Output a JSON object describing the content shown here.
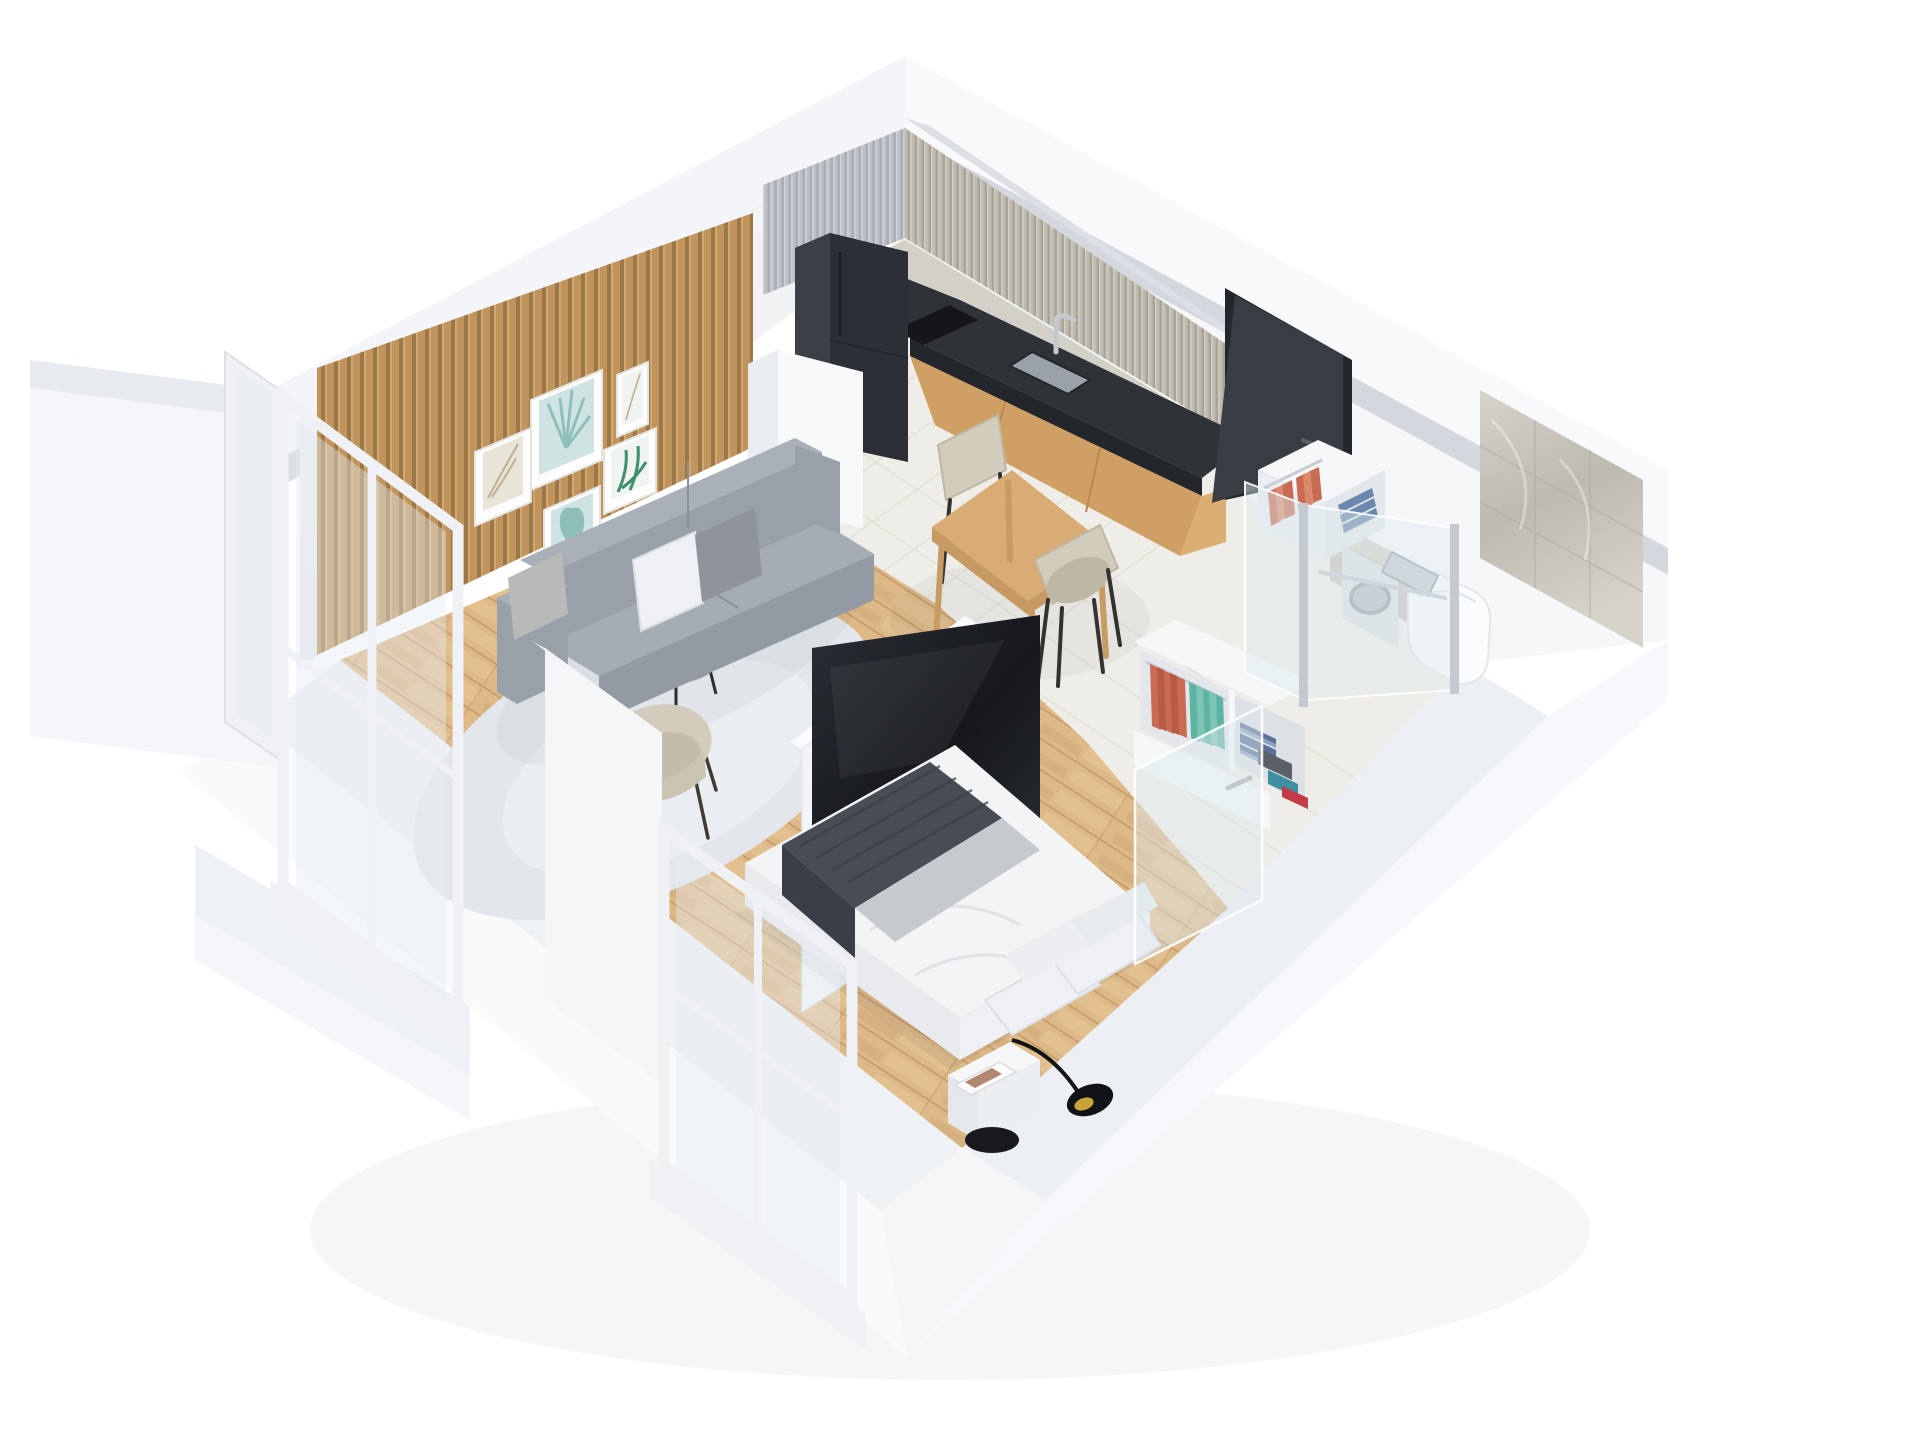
{
  "meta": {
    "title": "Isometric 3D cutaway render of a studio apartment floor plan",
    "view": "axonometric top-down cutaway",
    "canvas": {
      "width": 1920,
      "height": 1440
    }
  },
  "colors": {
    "bg": "#ffffff",
    "outerBandNW": "#f3f5f8",
    "outerBandNE": "#f7f9fb",
    "cutBand": "#dcdfe4",
    "cutBandDark": "#d4d7dd",
    "plinthTopSW": "#eff2f5",
    "plinthFaceSW": "#f9fafc",
    "plinthTopSE": "#ecEFf4",
    "plinthFaceSE": "#f6f8fb",
    "wallNW1": "#f4f5f7",
    "wallNW2": "#e9ecef",
    "wallNE": "#f6f7f9",
    "slatBase": "#c89a63",
    "slatDark": "#a07a4a",
    "slatLight": "#dab077",
    "frameWhite": "#fdfdfd",
    "frameEdge": "#e4e4e0",
    "artTealLight": "#cfe4e2",
    "artTeal": "#8fbfba",
    "artGreen": "#3e8f6a",
    "artBeige": "#e9e4d8",
    "artBeigeDark": "#bdb093",
    "artPale": "#eff3f1",
    "fluteCoolBase": "#bdc0c5",
    "fluteCoolDark": "#a9adb3",
    "fluteCoolLight": "#cdd0d5",
    "fluteWarmBase": "#c0bbb0",
    "fluteWarmDark": "#a9a498",
    "fluteWarmLight": "#d0ccc2",
    "splashMarble": "#d3d0c8",
    "counterTop": "#2f3338",
    "counterFace": "#23262b",
    "sinkGray": "#9aa1a8",
    "chrome": "#c3c9cf",
    "chromeDark": "#9aa1a8",
    "cooktop": "#141619",
    "woodCab": "#cf9f63",
    "woodCabDark": "#b9894f",
    "woodCabEnd": "#dcae72",
    "fridgeFront": "#2c3036",
    "fridgeSide": "#3a4046",
    "fridgeTop": "#24272b",
    "fridgeSeam": "#1d2023",
    "colWhiteF": "#f7f9fb",
    "colWhiteS": "#e9edf1",
    "colWhiteT": "#eef1f4",
    "doorDark": "#383c43",
    "doorFrame": "#23262b",
    "marble1": "#d6d3ca",
    "marble2": "#bdbab0",
    "marbleVein": "#a9a69b",
    "halfWall": "#c7c4bb",
    "toilet": "#fbfcfd",
    "toiletShade": "#e3e6ea",
    "washerFront": "#dde0e3",
    "washerRing": "#9aa0a7",
    "washerGlass": "#b9bec4",
    "glassFill": "rgba(222,232,238,0.45)",
    "glassStroke": "rgba(255,255,255,0.9)",
    "floorWood": "#deb988",
    "plankLine": "#c49a68",
    "plankLight": "#e7c797",
    "tile": "#efede8",
    "grout": "#dfdcd5",
    "rug": "#e3e7eb",
    "rugInner": "#ebeef1",
    "tableWood": "#d8ac74",
    "tableEdge": "#c69a62",
    "tableLeg": "#c79b63",
    "chairBeige": "#d2ccbd",
    "chairBeigeDark": "#bfb7a5",
    "chairLeg": "#35312c",
    "sofaBack": "#aab0b8",
    "sofaMid": "#9aa0a9",
    "sofaSeat": "#a6acb4",
    "sofaDark": "#8a9099",
    "sofaFront": "#939aa3",
    "pillowWhite": "#eef0f3",
    "pillowGray": "#8f939b",
    "pillowShade": "#dcdfe3",
    "tvDark1": "#2b3036",
    "tvDark2": "#15171b",
    "partWhite": "#f2f4f7",
    "partTop": "#fafbfd",
    "partEdge": "#e4e7eb",
    "bedSideSW": "#e8eaed",
    "bedSideSE": "#eef0f3",
    "duvet": "#f3f4f6",
    "duvetLine": "#dfe2e6",
    "throw1": "#474c55",
    "throw2": "#393e47",
    "nightTop": "#f6f7f9",
    "nightFront": "#eceff2",
    "nightSide": "#e4e7eb",
    "lampBlack": "#121316",
    "lampGold": "#c9a43c",
    "stoolBlack": "#17191c",
    "wardWhite": "#f5f7f9",
    "wardShade": "#eaedf1",
    "wardInner": "#e3e7ec",
    "wardInnerDark": "#dde1e6",
    "railChrome": "#c6ccd2",
    "clothCoral1": "#c96a52",
    "clothCoral2": "#d98a6a",
    "clothCoral3": "#b85a48",
    "clothTeal1": "#5fb3a1",
    "clothTeal2": "#7cc4b4",
    "jeans1": "#5a7099",
    "jeans2": "#6b87ae",
    "jeans3": "#4e6288",
    "foldGray": "#5a5f68",
    "foldTealBox": "#3f8fa3",
    "foldRed": "#c23b49",
    "foldBlueLight": "#8aa2c4",
    "winFrame": "#eff1f4",
    "winFrameShade": "#dde1e6",
    "winGlass": "rgba(228,236,240,0.42)",
    "pierFace": "#f5f6f8",
    "pierTop": "#e9ecf0",
    "balc1": "#f4f6f9",
    "balc2": "#eef1f5",
    "balc3": "#e7ebf0",
    "shadow": "rgba(30,41,59,0.07)",
    "shadowSoft": "rgba(30,41,59,0.045)"
  },
  "scene": {
    "background": "#ffffff",
    "style": "white cutaway walls, oak and light-tile floors, scandinavian furniture",
    "rooms": [
      {
        "id": "living-room",
        "label": "Living room",
        "floor": "oak plank",
        "features": [
          "wood-slat-accent-wall",
          "gallery-wall-five-botanical-prints",
          "gray-three-seat-sofa",
          "two-throw-pillows",
          "round-gray-rug",
          "two-round-nesting-coffee-tables",
          "beige-armchair"
        ]
      },
      {
        "id": "kitchen",
        "label": "Kitchen",
        "floor": "light tile",
        "features": [
          "dark-two-door-fridge",
          "white-tall-column",
          "gray-fluted-upper-cabinets-both-walls",
          "marble-backsplash-strip",
          "dark-stone-countertop-L-shape",
          "induction-cooktop",
          "undermount-sink",
          "chrome-faucet",
          "oak-base-cabinets"
        ]
      },
      {
        "id": "dining-area",
        "label": "Dining area",
        "floor": "light tile",
        "features": [
          "oak-dining-table",
          "beige-upholstered-chair-north",
          "beige-upholstered-chair-south"
        ]
      },
      {
        "id": "sleeping-area",
        "label": "Sleeping area",
        "floor": "oak plank",
        "features": [
          "double-bed-white-duvet",
          "stacked-white-pillows",
          "dark-gray-fringed-throw",
          "white-tv-partition-wall",
          "flat-screen-tv",
          "white-nightstand",
          "black-task-lamp",
          "black-round-side-table"
        ]
      },
      {
        "id": "wardrobe",
        "label": "Wardrobe / hallway",
        "floor": "light tile",
        "features": [
          "open-white-shelf-unit-near-door",
          "open-white-shelf-unit-large",
          "hanging-coral-clothes",
          "hanging-teal-clothes",
          "folded-denim-stack",
          "folded-gray-stack",
          "teal-storage-box",
          "red-folded-sweater"
        ]
      },
      {
        "id": "bathroom",
        "label": "Bathroom",
        "floor": "light tile",
        "features": [
          "glass-partition-two-panes",
          "chrome-posts",
          "swung-open-glass-door",
          "tall-marble-shower-wall",
          "marble-half-wall",
          "wall-hung-toilet",
          "chrome-flush-plate",
          "chrome-towel-bar",
          "washing-machine"
        ]
      },
      {
        "id": "entry",
        "label": "Entry",
        "features": [
          "dark-anthracite-door-ajar"
        ]
      },
      {
        "id": "balconies",
        "label": "Balconies",
        "features": [
          "white-framed-glazed-door-west-corner",
          "white-framed-window-at-bed",
          "white-balcony-volumes"
        ]
      }
    ],
    "counts": {
      "wall_art_frames": 5,
      "dining_chairs": 2,
      "coffee_tables": 2,
      "glass_posts": 2,
      "wardrobe_units": 2
    }
  }
}
